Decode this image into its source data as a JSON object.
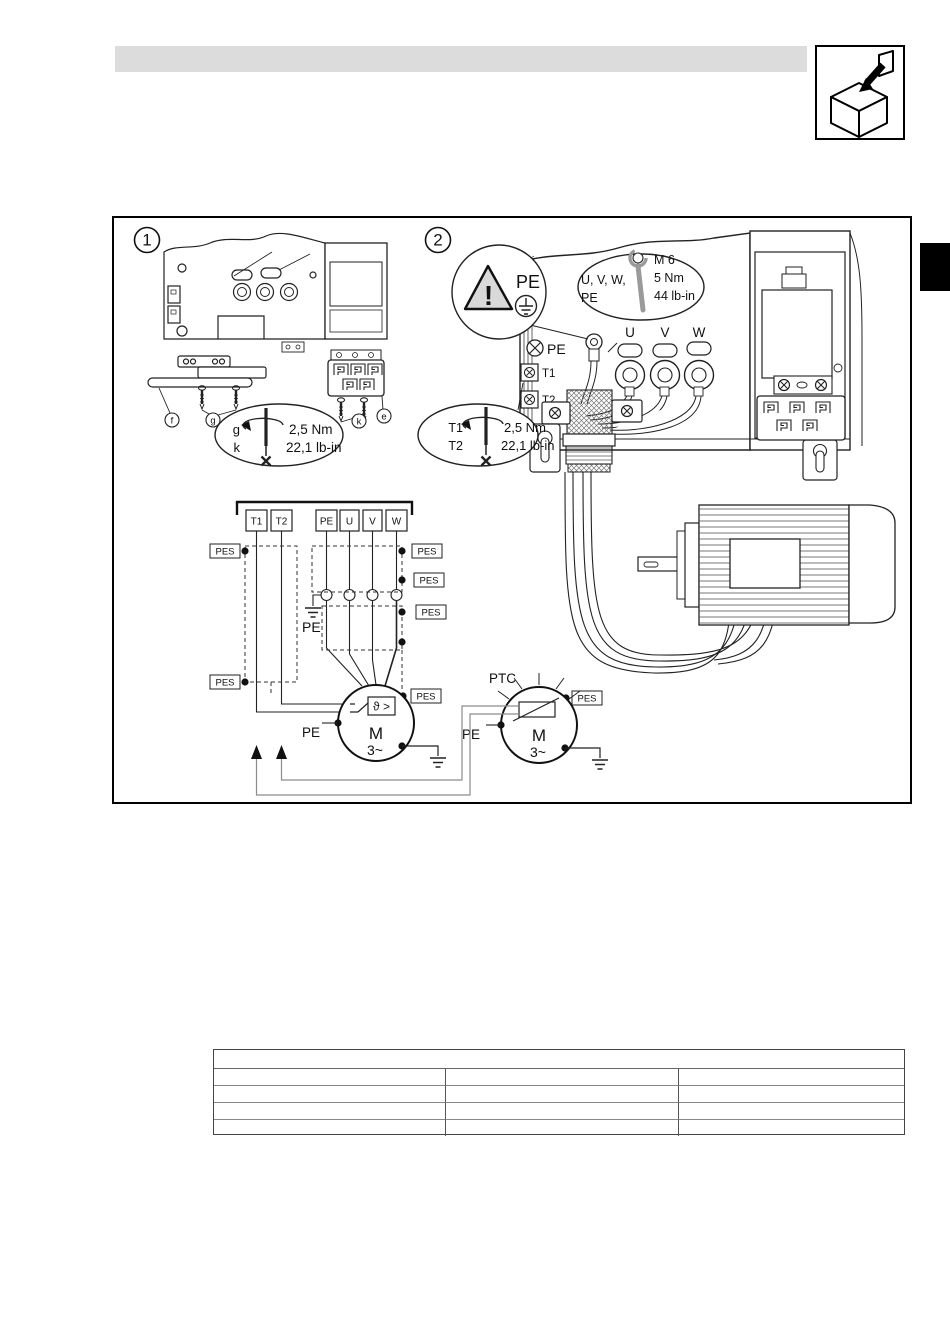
{
  "colors": {
    "line": "#1a1a1a",
    "gray_line": "#8c8c8c",
    "header_bar": "#dcdcdc",
    "triangle_fill": "#d9d9d9"
  },
  "corner_icon": {
    "name": "module-insert-icon"
  },
  "figure": {
    "panel1": {
      "number": "1",
      "callout_f": "f",
      "callout_g": "g",
      "callout_k": "k",
      "callout_e": "e",
      "torque": {
        "line1": "g",
        "line2": "k",
        "nm": "2,5 Nm",
        "lbin": "22,1 lb-in"
      }
    },
    "panel2": {
      "number": "2",
      "pe_badge": "PE",
      "pe_terminal": "PE",
      "t1": "T1",
      "t2": "T2",
      "u": "U",
      "v": "V",
      "w": "W",
      "torque": {
        "line1": "T1",
        "line2": "T2",
        "nm": "2,5 Nm",
        "lbin": "22,1 lb-in"
      },
      "bolt": {
        "targets": "U, V, W,",
        "pe": "PE",
        "size": "M 6",
        "nm": "5 Nm",
        "lbin": "44 lb-in"
      }
    },
    "schematic": {
      "t1": "T1",
      "t2": "T2",
      "pe": "PE",
      "u": "U",
      "v": "V",
      "w": "W",
      "pes": "PES",
      "pe_ground": "PE",
      "motor1_sensor": "ϑ >",
      "motor1_m": "M",
      "motor1_ph": "3~",
      "motor1_pe": "PE",
      "ptc": "PTC",
      "motor2_m": "M",
      "motor2_ph": "3~",
      "motor2_pe": "PE"
    }
  },
  "table": {
    "col_count": 3,
    "row_count": 4
  }
}
